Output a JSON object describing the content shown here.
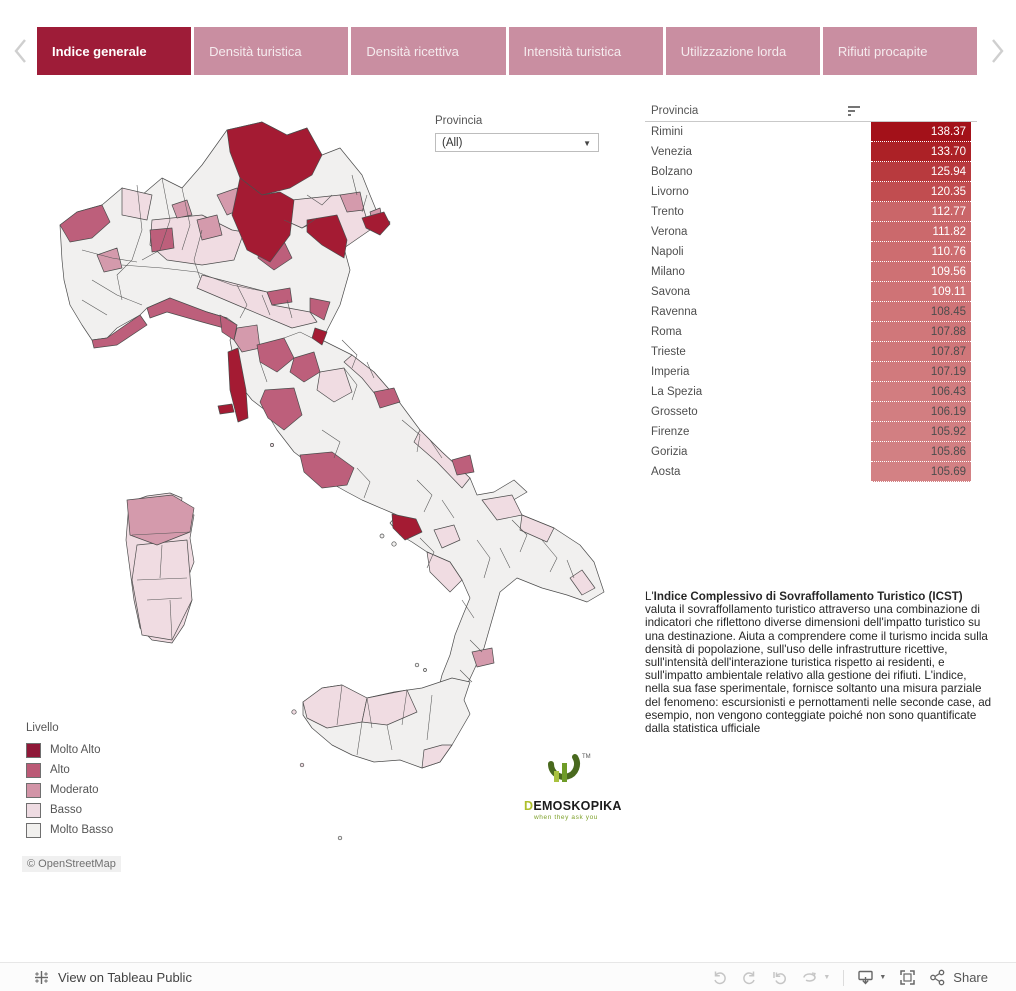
{
  "tabs": {
    "items": [
      {
        "label": "Indice generale",
        "active": true
      },
      {
        "label": "Densità turistica",
        "active": false
      },
      {
        "label": "Densità ricettiva",
        "active": false
      },
      {
        "label": "Intensità turistica",
        "active": false
      },
      {
        "label": "Utilizzazione lorda",
        "active": false
      },
      {
        "label": "Rifiuti procapite",
        "active": false
      }
    ]
  },
  "filter": {
    "label": "Provincia",
    "value": "(All)"
  },
  "table": {
    "header": "Provincia",
    "rows": [
      {
        "name": "Rimini",
        "value": "138.37",
        "bg": "#a31119",
        "fg": "#ffffff"
      },
      {
        "name": "Venezia",
        "value": "133.70",
        "bg": "#ac2126",
        "fg": "#ffffff"
      },
      {
        "name": "Bolzano",
        "value": "125.94",
        "bg": "#b83a3e",
        "fg": "#ffffff"
      },
      {
        "name": "Livorno",
        "value": "120.35",
        "bg": "#c14d50",
        "fg": "#ffffff"
      },
      {
        "name": "Trento",
        "value": "112.77",
        "bg": "#ca6669",
        "fg": "#ffffff"
      },
      {
        "name": "Verona",
        "value": "111.82",
        "bg": "#cb696c",
        "fg": "#ffffff"
      },
      {
        "name": "Napoli",
        "value": "110.76",
        "bg": "#cd6d70",
        "fg": "#ffffff"
      },
      {
        "name": "Milano",
        "value": "109.56",
        "bg": "#ce7174",
        "fg": "#ffffff"
      },
      {
        "name": "Savona",
        "value": "109.11",
        "bg": "#cf7376",
        "fg": "#ffffff"
      },
      {
        "name": "Ravenna",
        "value": "108.45",
        "bg": "#d07578",
        "fg": "#4d4d4d"
      },
      {
        "name": "Roma",
        "value": "107.88",
        "bg": "#d0777a",
        "fg": "#4d4d4d"
      },
      {
        "name": "Trieste",
        "value": "107.87",
        "bg": "#d0777a",
        "fg": "#4d4d4d"
      },
      {
        "name": "Imperia",
        "value": "107.19",
        "bg": "#d17a7d",
        "fg": "#4d4d4d"
      },
      {
        "name": "La Spezia",
        "value": "106.43",
        "bg": "#d27d80",
        "fg": "#4d4d4d"
      },
      {
        "name": "Grosseto",
        "value": "106.19",
        "bg": "#d27e81",
        "fg": "#4d4d4d"
      },
      {
        "name": "Firenze",
        "value": "105.92",
        "bg": "#d27f82",
        "fg": "#4d4d4d"
      },
      {
        "name": "Gorizia",
        "value": "105.86",
        "bg": "#d28083",
        "fg": "#4d4d4d"
      },
      {
        "name": "Aosta",
        "value": "105.69",
        "bg": "#d38184",
        "fg": "#4d4d4d"
      }
    ]
  },
  "legend": {
    "title": "Livello",
    "items": [
      {
        "label": "Molto Alto",
        "color": "#8f1838"
      },
      {
        "label": "Alto",
        "color": "#bb5a76"
      },
      {
        "label": "Moderato",
        "color": "#d294a7"
      },
      {
        "label": "Basso",
        "color": "#eedbe2"
      },
      {
        "label": "Molto Basso",
        "color": "#f1f0ee"
      }
    ]
  },
  "map": {
    "attribution": "© OpenStreetMap"
  },
  "description": {
    "prefix": "L'",
    "bold": "Indice Complessivo di Sovraffollamento Turistico (ICST)",
    "body": " valuta il sovraffollamento turistico attraverso una combinazione di indicatori che riflettono diverse dimensioni dell'impatto turistico su una destinazione. Aiuta a comprendere come il turismo incida sulla densità di popolazione, sull'uso delle infrastrutture ricettive, sull'intensità dell'interazione turistica rispetto ai residenti, e sull'impatto ambientale relativo alla gestione dei rifiuti. L'indice, nella sua fase sperimentale, fornisce soltanto una misura parziale del fenomeno: escursionisti e pernottamenti nelle seconde case, ad esempio, non vengono conteggiate poiché non sono quantificate dalla statistica ufficiale"
  },
  "logo": {
    "name_first": "D",
    "name_rest": "EMOSKOPIKA",
    "tagline": "when they ask you",
    "tm": "TM"
  },
  "toolbar": {
    "view_label": "View on Tableau Public",
    "share_label": "Share"
  },
  "colors": {
    "tab_active": "#9e1c38",
    "tab_inactive": "#c98ea1",
    "map_classes": {
      "molto_alto": "#a41b33",
      "alto": "#bd5f7b",
      "moderato": "#d49aac",
      "basso": "#f0dce2",
      "molto_basso": "#f1f0ef"
    }
  },
  "chart_data": {
    "type": "table",
    "title": "Indice Complessivo di Sovraffollamento Turistico (ICST)",
    "categories": [
      "Rimini",
      "Venezia",
      "Bolzano",
      "Livorno",
      "Trento",
      "Verona",
      "Napoli",
      "Milano",
      "Savona",
      "Ravenna",
      "Roma",
      "Trieste",
      "Imperia",
      "La Spezia",
      "Grosseto",
      "Firenze",
      "Gorizia",
      "Aosta"
    ],
    "values": [
      138.37,
      133.7,
      125.94,
      120.35,
      112.77,
      111.82,
      110.76,
      109.56,
      109.11,
      108.45,
      107.88,
      107.87,
      107.19,
      106.43,
      106.19,
      105.92,
      105.86,
      105.69
    ]
  }
}
